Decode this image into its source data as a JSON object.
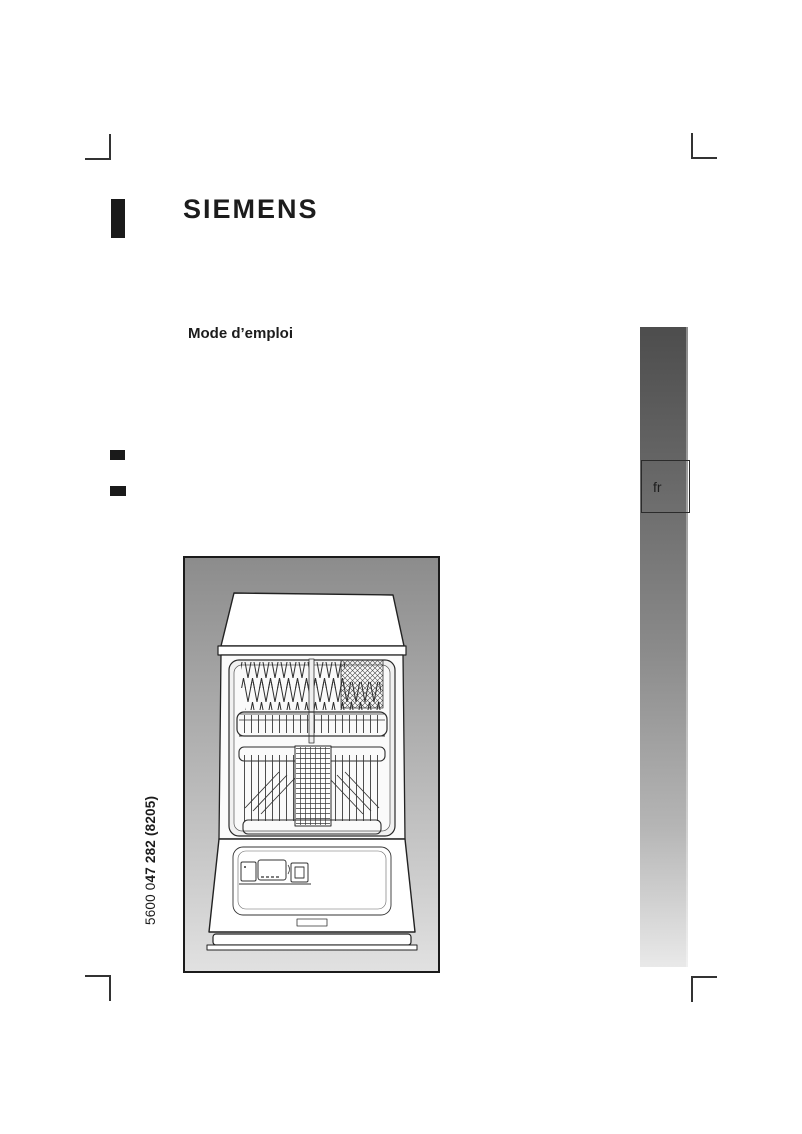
{
  "cover": {
    "brand": "SIEMENS",
    "title": "Mode d’emploi",
    "doc_number_prefix": "5600 0",
    "doc_number_main": "47 282 (8205)",
    "language_tab": "fr"
  },
  "illustration": {
    "label": "dishwasher-front-open-line-drawing"
  },
  "colors": {
    "text": "#1d1d1d",
    "registration_black": "#1a1a1a",
    "crop_mark": "#333333",
    "sidebar_gradient_top": "#4d4d4d",
    "sidebar_gradient_bottom": "#e9e9e9",
    "illustration_bg_top": "#8c8c8c",
    "illustration_bg_bottom": "#e1e1e1",
    "line_art": "#222222"
  }
}
